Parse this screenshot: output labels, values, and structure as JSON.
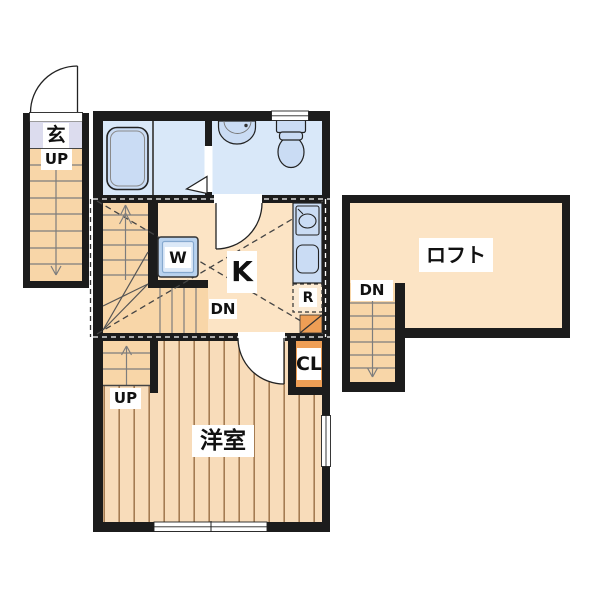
{
  "plan_title": "apartment-floor-plan",
  "labels": {
    "entrance_room": "玄",
    "entrance_up": "UP",
    "kitchen": "K",
    "kitchen_down": "DN",
    "washer": "W",
    "refrigerator": "R",
    "closet": "CL",
    "western_room": "洋室",
    "western_room_up": "UP",
    "loft": "ロフト",
    "loft_down": "DN"
  },
  "colors": {
    "wall": "#1c1c1c",
    "floor": "#fce4c5",
    "floor2": "#f8dcba",
    "stairs": "#f8d6a8",
    "bath": "#d9e8f9",
    "fixture": "#cadcf4",
    "appliance": "#b9d2ee",
    "appliance_inner": "#dce9f8",
    "entrance": "#dcdcee",
    "accent": "#ee9e55",
    "stripe": "#a57c52",
    "line": "#222222",
    "tread": "#7d7d7d",
    "fridge_bg": "#fbead3"
  }
}
